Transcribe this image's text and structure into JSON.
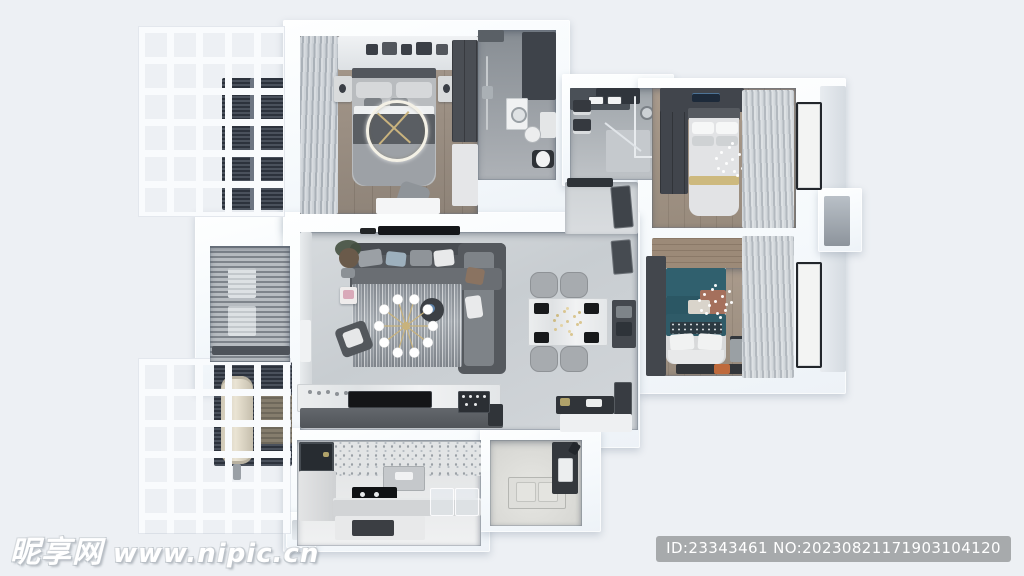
{
  "watermark": {
    "site_name": "昵享网",
    "site_url": "www.nipic.cn"
  },
  "id_badge": {
    "text": "ID:23343461 NO:20230821171903104120"
  },
  "palette": {
    "background": "#edf0f4",
    "wall_white": "#fafdfe",
    "floor_tile": "#ccd1d5",
    "floor_wood": "#9c8e80",
    "dark_furniture": "#42464c",
    "accent_teal": "#30606e",
    "accent_rust": "#a5705c",
    "accent_gold": "#cdb97e",
    "badge_gray": "#a7aaac",
    "watermark_white": "#ffffff"
  }
}
